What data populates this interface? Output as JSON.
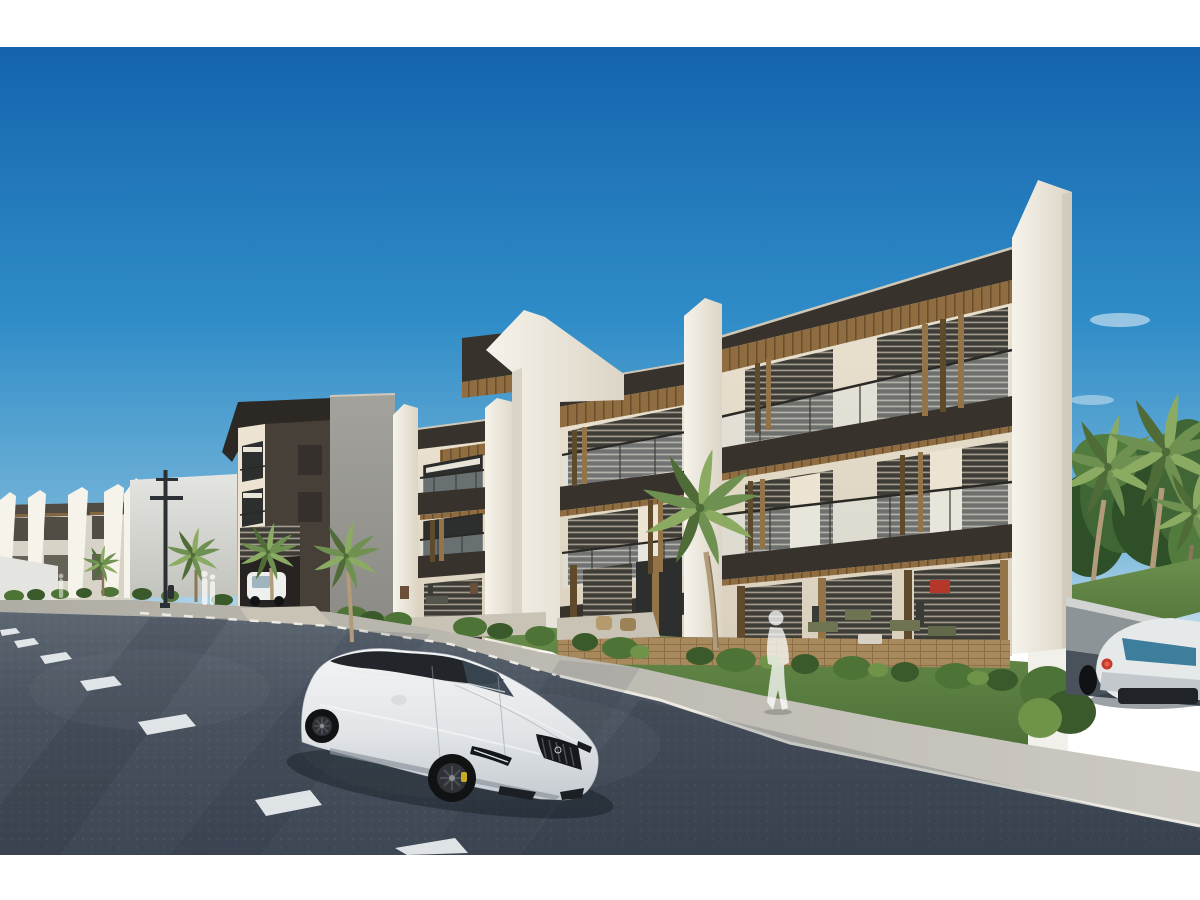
{
  "meta": {
    "title": "Architectural rendering — modern apartment complex street view",
    "description": "3D architectural rendering of a modern three-story apartment complex with white angled fin walls, dark fascia bands, wood slat accents, louvered glass facades and glass balcony railings. A white sports sedan is parked on the dark asphalt road in the foreground, a white coupe exits a side ramp at the right, palm trees, lawns and shrubs line the street, and translucent pedestrian silhouettes walk along the sidewalk under a clear blue sky."
  },
  "frame": {
    "top_band_height": 47,
    "bottom_band_height": 45
  },
  "palette": {
    "frame_band": "#ffffff",
    "sky_top": "#1464ad",
    "sky_mid": "#2f8cc7",
    "sky_low": "#79b7da",
    "sky_horizon": "#cfe3ee",
    "cloud": "#ffffff",
    "wall_lit": "#ece3d2",
    "wall_low": "#d9cfbc",
    "fin_lit": "#f6f3eb",
    "fin_shade": "#dcd5c6",
    "fin_edge": "#c4bcab",
    "fascia": "#37322c",
    "fascia_cap": "#cfc8b8",
    "wood": "#8f6d41",
    "wood_dark": "#6a4f2e",
    "slat_light": "#937448",
    "slat_dark": "#5f4a2c",
    "louver_dark": "#3e3c36",
    "louver_stripe": "#b3ac9c",
    "glass_dark": "#2c2f2e",
    "glass_rail": "#ddeaf2",
    "handrail": "#2b2925",
    "post": "#3a3833",
    "tower_face": "#474038",
    "tower_side": "#35302b",
    "tower_roof": "#2c2824",
    "entry_dark": "#262320",
    "gray_wall": "#a3a29c",
    "gray_wall_low": "#8a8983",
    "leftrow_base": "#d7d3c7",
    "leftrow_win": "#514d44",
    "bigwall_top": "#e4e5e1",
    "bigwall_bot": "#c2c3bd",
    "lawn_a": "#6b8f4d",
    "lawn_b": "#4d7037",
    "bush_dark": "#3a5a2b",
    "bush_mid": "#4e7336",
    "bush_light": "#6f9449",
    "palm_a": "#6e9050",
    "palm_b": "#8cab62",
    "palm_dark": "#4f6b37",
    "trunk": "#b19b7a",
    "trunk_dark": "#8a7659",
    "tree_dark": "#2f4f29",
    "tree_mid": "#3f6634",
    "tree_light": "#527b3e",
    "road_top": "#5d6772",
    "road_mid": "#49525e",
    "road_bot": "#3e4754",
    "road_shadow": "#242e3a",
    "road_worn": "#7d8894",
    "marking": "#edf1f3",
    "sidewalk": "#b0ada4",
    "sidewalk_light": "#ccc9c2",
    "curb": "#eceae3",
    "patio": "#c9c3b6",
    "ret_cap": "#d1d4d3",
    "ret_wall": "#8d9498",
    "ramp": "#49525a",
    "pillar": "#f2f0ea",
    "car_hi": "#f3f4f5",
    "car_mid": "#e2e5e8",
    "car_lo": "#c5cbd1",
    "glasshouse": "#22252a",
    "car_glass": "#394450",
    "car_line": "#9aa1a8",
    "wheel": "#101214",
    "rim": "#2e3237",
    "caliper": "#c9ab25",
    "grille": "#16181b",
    "ferrari_body": "#e6e9ea",
    "ferrari_shade": "#c2c8cc",
    "ferrari_glass": "#3e7e9d",
    "taillight": "#c23a2c",
    "taillight_hi": "#e8604e",
    "diffuser": "#202327",
    "ghost": "#ffffff",
    "pole": "#2b3034",
    "deck": "#a8895c",
    "deck_line": "#8a6f48",
    "cart": "#eef0ee",
    "cart_glass": "#9fb4bd",
    "red_art": "#b5372a"
  },
  "scene": {
    "sky": {
      "label": "clear blue sky",
      "clouds": 4
    },
    "buildings": {
      "main": {
        "label": "three-story modern apartment building",
        "floors": 3,
        "features": [
          "white angled fin walls",
          "dark fascia bands",
          "wood soffits",
          "louvered glass walls",
          "glass balcony railings",
          "vertical wood slats"
        ]
      },
      "corner_tower": {
        "label": "dark charcoal corner block with entry portal and parked golf cart"
      },
      "left_row": {
        "label": "receding row of matching apartment blocks"
      },
      "side_wall": {
        "label": "blank white side wall"
      }
    },
    "vehicles": {
      "hero_car": {
        "label": "white sports sedan",
        "wheels": "black",
        "calipers": "yellow"
      },
      "background_car": {
        "label": "white sports coupe on side ramp",
        "taillight": "red"
      },
      "golf_cart": {
        "label": "white golf cart inside entry portal"
      }
    },
    "landscape": {
      "palms_foreground": 5,
      "palms_background": 3,
      "lawn": "green strip with shrubs",
      "road": "dark asphalt with dashed white lane markings",
      "street_lamp": 1,
      "bollard": 1
    },
    "people": {
      "silhouettes": 3,
      "style": "translucent white"
    }
  }
}
